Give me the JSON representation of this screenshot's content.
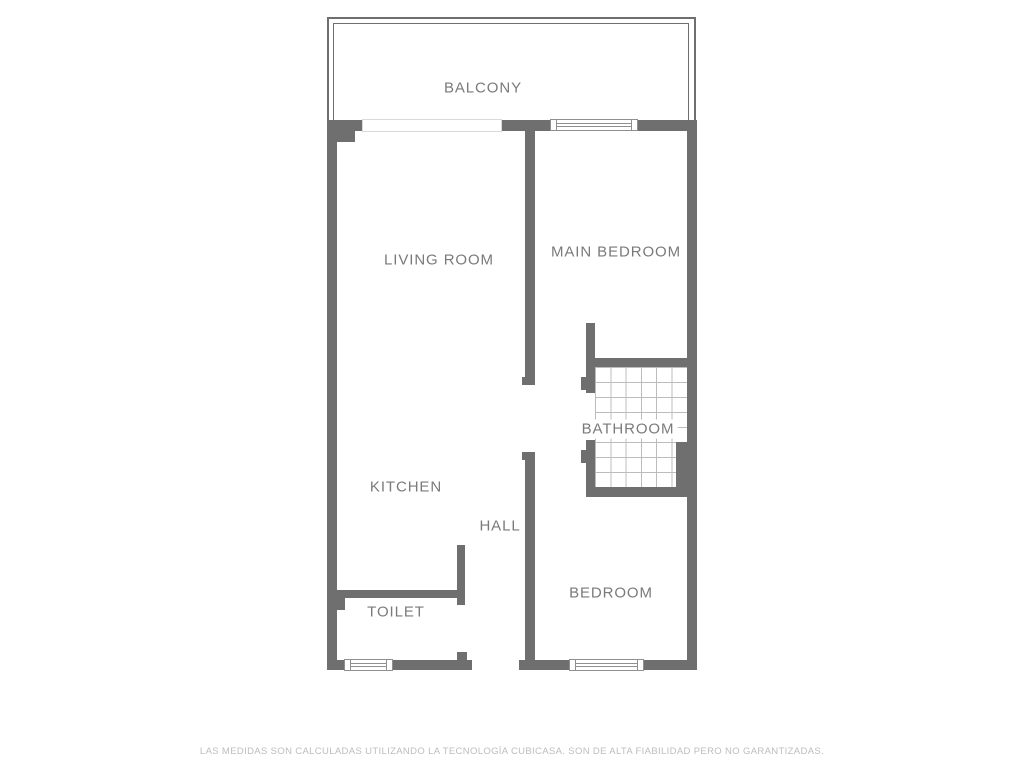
{
  "disclaimer": {
    "text": "LAS MEDIDAS SON CALCULADAS UTILIZANDO LA TECNOLOGÍA CUBICASA. SON DE ALTA FIABILIDAD PERO NO GARANTIZADAS."
  },
  "colors": {
    "wall": "#6f6f6f",
    "label": "#7a7a7a",
    "tile_line": "#bcbcbc",
    "window_border": "#8f8f8f",
    "disclaimer": "#bdbdbd",
    "door_outline": "#dadada"
  },
  "rooms": [
    {
      "id": "balcony",
      "label": "BALCONY",
      "x": 483,
      "y": 88
    },
    {
      "id": "living-room",
      "label": "LIVING ROOM",
      "x": 439,
      "y": 260
    },
    {
      "id": "main-bedroom",
      "label": "MAIN BEDROOM",
      "x": 616,
      "y": 252
    },
    {
      "id": "bathroom",
      "label": "BATHROOM",
      "x": 628,
      "y": 429,
      "bg": true
    },
    {
      "id": "kitchen",
      "label": "KITCHEN",
      "x": 406,
      "y": 487
    },
    {
      "id": "hall",
      "label": "HALL",
      "x": 500,
      "y": 526
    },
    {
      "id": "toilet",
      "label": "TOILET",
      "x": 396,
      "y": 612
    },
    {
      "id": "bedroom",
      "label": "BEDROOM",
      "x": 611,
      "y": 593
    }
  ],
  "compass": {
    "name": "north-compass",
    "direction": "north-west-arrow"
  },
  "plan": {
    "balcony": {
      "outer": {
        "x": 327,
        "y": 17,
        "w": 369,
        "h": 108
      },
      "inner": {
        "x": 333,
        "y": 23,
        "w": 356,
        "h": 102
      }
    },
    "tiles": {
      "name": "bathroom-tile-grid",
      "x": 595,
      "y": 367,
      "w": 92,
      "h": 120
    },
    "walls": [
      {
        "name": "top-wall-left",
        "x": 327,
        "y": 120,
        "w": 35,
        "h": 11
      },
      {
        "name": "top-wall-mid",
        "x": 502,
        "y": 120,
        "w": 49,
        "h": 11
      },
      {
        "name": "top-wall-right",
        "x": 637,
        "y": 120,
        "w": 60,
        "h": 11
      },
      {
        "name": "left-wall",
        "x": 327,
        "y": 120,
        "w": 10,
        "h": 550
      },
      {
        "name": "right-wall",
        "x": 687,
        "y": 120,
        "w": 10,
        "h": 550
      },
      {
        "name": "bottom-wall-a",
        "x": 327,
        "y": 660,
        "w": 18,
        "h": 10
      },
      {
        "name": "bottom-wall-b",
        "x": 392,
        "y": 660,
        "w": 80,
        "h": 10
      },
      {
        "name": "bottom-wall-c",
        "x": 519,
        "y": 660,
        "w": 51,
        "h": 10
      },
      {
        "name": "bottom-wall-d",
        "x": 643,
        "y": 660,
        "w": 54,
        "h": 10
      },
      {
        "name": "livingroom-bedroom-divider",
        "x": 525,
        "y": 131,
        "w": 10,
        "h": 254
      },
      {
        "name": "divider-end-cap",
        "x": 522,
        "y": 377,
        "w": 13,
        "h": 8
      },
      {
        "name": "main-bedroom-bottom-wall",
        "x": 586,
        "y": 358,
        "w": 101,
        "h": 9
      },
      {
        "name": "bathroom-left-wall-upper",
        "x": 586,
        "y": 323,
        "w": 9,
        "h": 70
      },
      {
        "name": "bathroom-door-jamb-upper",
        "x": 581,
        "y": 377,
        "w": 5,
        "h": 13
      },
      {
        "name": "bathroom-left-wall-lower",
        "x": 586,
        "y": 440,
        "w": 9,
        "h": 57
      },
      {
        "name": "bathroom-door-jamb-lower",
        "x": 581,
        "y": 450,
        "w": 5,
        "h": 13
      },
      {
        "name": "bathroom-bottom-wall",
        "x": 586,
        "y": 487,
        "w": 111,
        "h": 10
      },
      {
        "name": "bathroom-right-block",
        "x": 676,
        "y": 442,
        "w": 11,
        "h": 55
      },
      {
        "name": "hall-bedroom-divider",
        "x": 525,
        "y": 452,
        "w": 10,
        "h": 208
      },
      {
        "name": "hall-divider-end-cap",
        "x": 522,
        "y": 452,
        "w": 13,
        "h": 8
      },
      {
        "name": "toilet-top-wall",
        "x": 337,
        "y": 590,
        "w": 120,
        "h": 8
      },
      {
        "name": "toilet-right-wall",
        "x": 457,
        "y": 545,
        "w": 8,
        "h": 60
      },
      {
        "name": "toilet-door-stub",
        "x": 457,
        "y": 652,
        "w": 10,
        "h": 8
      },
      {
        "name": "left-wall-block",
        "x": 327,
        "y": 597,
        "w": 18,
        "h": 13
      },
      {
        "name": "top-left-stub",
        "x": 337,
        "y": 131,
        "w": 18,
        "h": 11
      }
    ],
    "doors": [
      {
        "name": "balcony-door-opening",
        "x": 362,
        "y": 119,
        "w": 140,
        "h": 13
      }
    ],
    "windows": [
      {
        "name": "main-bedroom-window",
        "x": 550,
        "y": 119,
        "w": 88,
        "h": 12
      },
      {
        "name": "toilet-window",
        "x": 344,
        "y": 659,
        "w": 49,
        "h": 12
      },
      {
        "name": "bedroom-window",
        "x": 569,
        "y": 659,
        "w": 75,
        "h": 12
      }
    ]
  }
}
